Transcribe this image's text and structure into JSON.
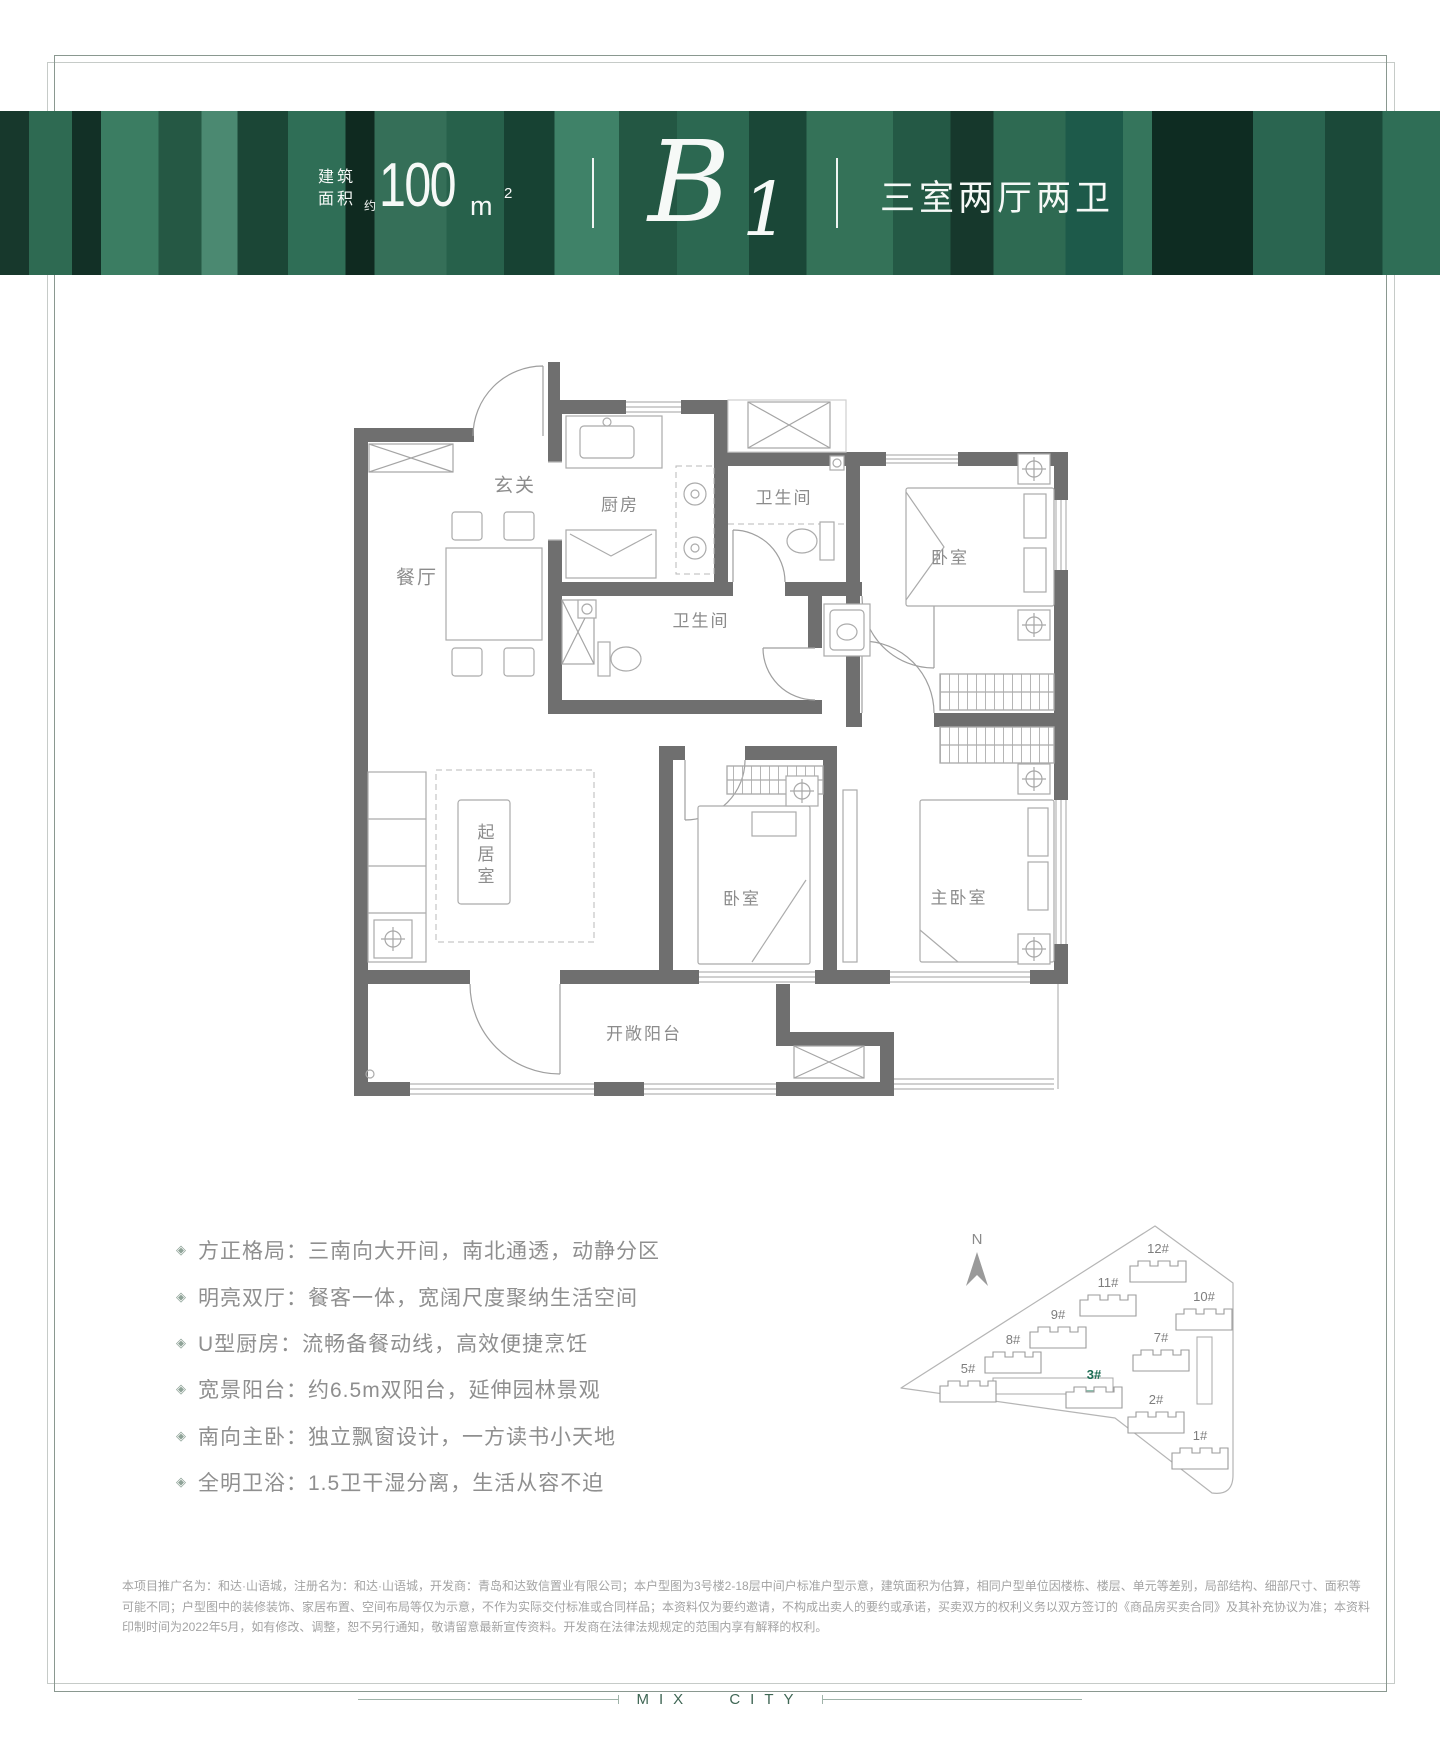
{
  "banner": {
    "area_label_line1": "建筑",
    "area_label_line2": "面积",
    "approx": "约",
    "area_value": "100",
    "area_unit": "m",
    "area_unit_sup": "2",
    "unit_letter": "B",
    "unit_number": "1",
    "layout_type": "三室两厅两卫"
  },
  "plan": {
    "rooms": [
      {
        "key": "foyer",
        "label": "玄关"
      },
      {
        "key": "kitchen",
        "label": "厨房"
      },
      {
        "key": "bath1",
        "label": "卫生间"
      },
      {
        "key": "bedroom1",
        "label": "卧室"
      },
      {
        "key": "dining",
        "label": "餐厅"
      },
      {
        "key": "bath2",
        "label": "卫生间"
      },
      {
        "key": "living",
        "label": "起居室"
      },
      {
        "key": "bedroom2",
        "label": "卧室"
      },
      {
        "key": "master",
        "label": "主卧室"
      },
      {
        "key": "balcony",
        "label": "开敞阳台"
      }
    ]
  },
  "features": [
    {
      "text": "方正格局：三南向大开间，南北通透，动静分区"
    },
    {
      "text": "明亮双厅：餐客一体，宽阔尺度聚纳生活空间"
    },
    {
      "text": "U型厨房：流畅备餐动线，高效便捷烹饪"
    },
    {
      "text": "宽景阳台：约6.5m双阳台，延伸园林景观"
    },
    {
      "text": "南向主卧：独立飘窗设计，一方读书小天地"
    },
    {
      "text": "全明卫浴：1.5卫干湿分离，生活从容不迫"
    }
  ],
  "site_map": {
    "north_label": "N",
    "highlight_color": "#8dbfae",
    "buildings": [
      {
        "label": "12#"
      },
      {
        "label": "11#"
      },
      {
        "label": "10#"
      },
      {
        "label": "9#"
      },
      {
        "label": "8#"
      },
      {
        "label": "7#"
      },
      {
        "label": "5#"
      },
      {
        "label": "3#",
        "highlighted": true
      },
      {
        "label": "2#"
      },
      {
        "label": "1#"
      }
    ]
  },
  "disclaimer_lines": [
    "本项目推广名为：和达·山语城，注册名为：和达·山语城，开发商：青岛和达致信置业有限公司；本户型图为3号楼2-18层中间户标准户型示意，建筑面积为估算，相同户型单位因楼栋、楼层、单元等差别，局部结构、细部尺寸、面积等",
    "可能不同；户型图中的装修装饰、家居布置、空间布局等仅为示意，不作为实际交付标准或合同样品；本资料仅为要约邀请，不构成出卖人的要约或承诺，买卖双方的权利义务以双方签订的《商品房买卖合同》及其补充协议为准；本资料",
    "印制时间为2022年5月，如有修改、调整，恕不另行通知，敬请留意最新宣传资料。开发商在法律法规规定的范围内享有解释的权利。"
  ],
  "footer": {
    "brand": "MIX CITY"
  }
}
